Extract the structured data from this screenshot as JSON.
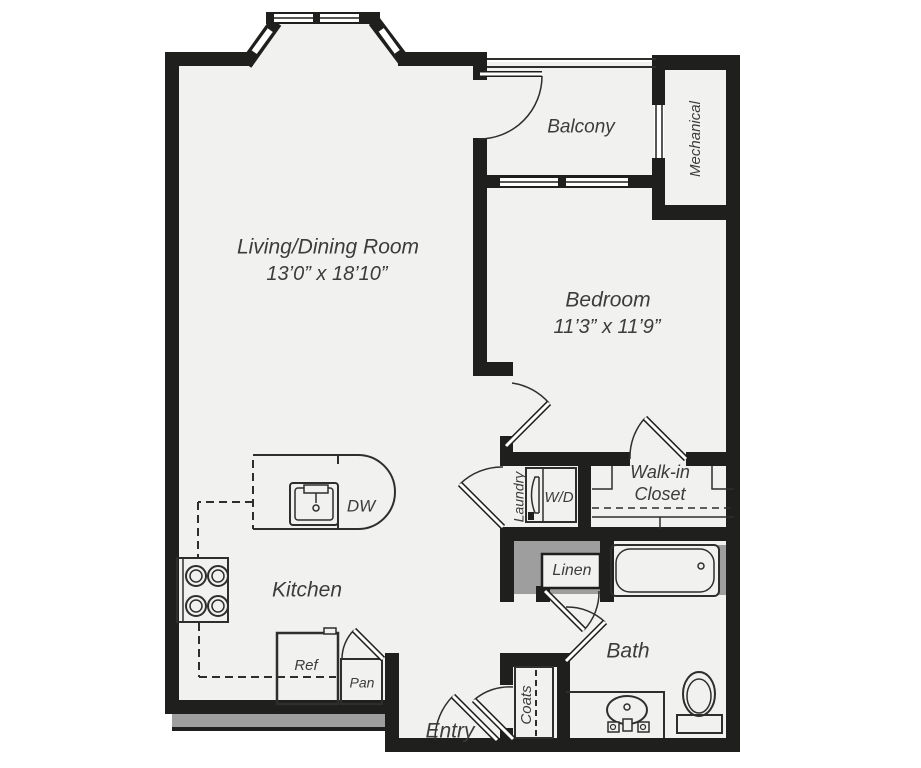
{
  "plan": {
    "title": "One-bedroom apartment floor plan",
    "colors": {
      "wall": "#1f1f1d",
      "floor": "#f1f1ef",
      "outside": "#ffffff",
      "accent_gray": "#9e9e9e",
      "text": "#3c3c3c"
    },
    "rooms": {
      "living_dining": {
        "name": "Living/Dining Room",
        "dimensions": "13’0” x 18’10”"
      },
      "bedroom": {
        "name": "Bedroom",
        "dimensions": "11’3” x 11’9”"
      },
      "balcony": {
        "name": "Balcony"
      },
      "mechanical": {
        "name": "Mechanical"
      },
      "kitchen": {
        "name": "Kitchen"
      },
      "bath": {
        "name": "Bath"
      },
      "walk_in_closet": {
        "name_line1": "Walk-in",
        "name_line2": "Closet"
      },
      "laundry": {
        "name": "Laundry"
      },
      "linen": {
        "name": "Linen"
      },
      "coats": {
        "name": "Coats"
      },
      "entry": {
        "name": "Entry"
      }
    },
    "fixtures": {
      "washer_dryer": "W/D",
      "dishwasher": "DW",
      "refrigerator": "Ref",
      "pantry": "Pan"
    }
  }
}
